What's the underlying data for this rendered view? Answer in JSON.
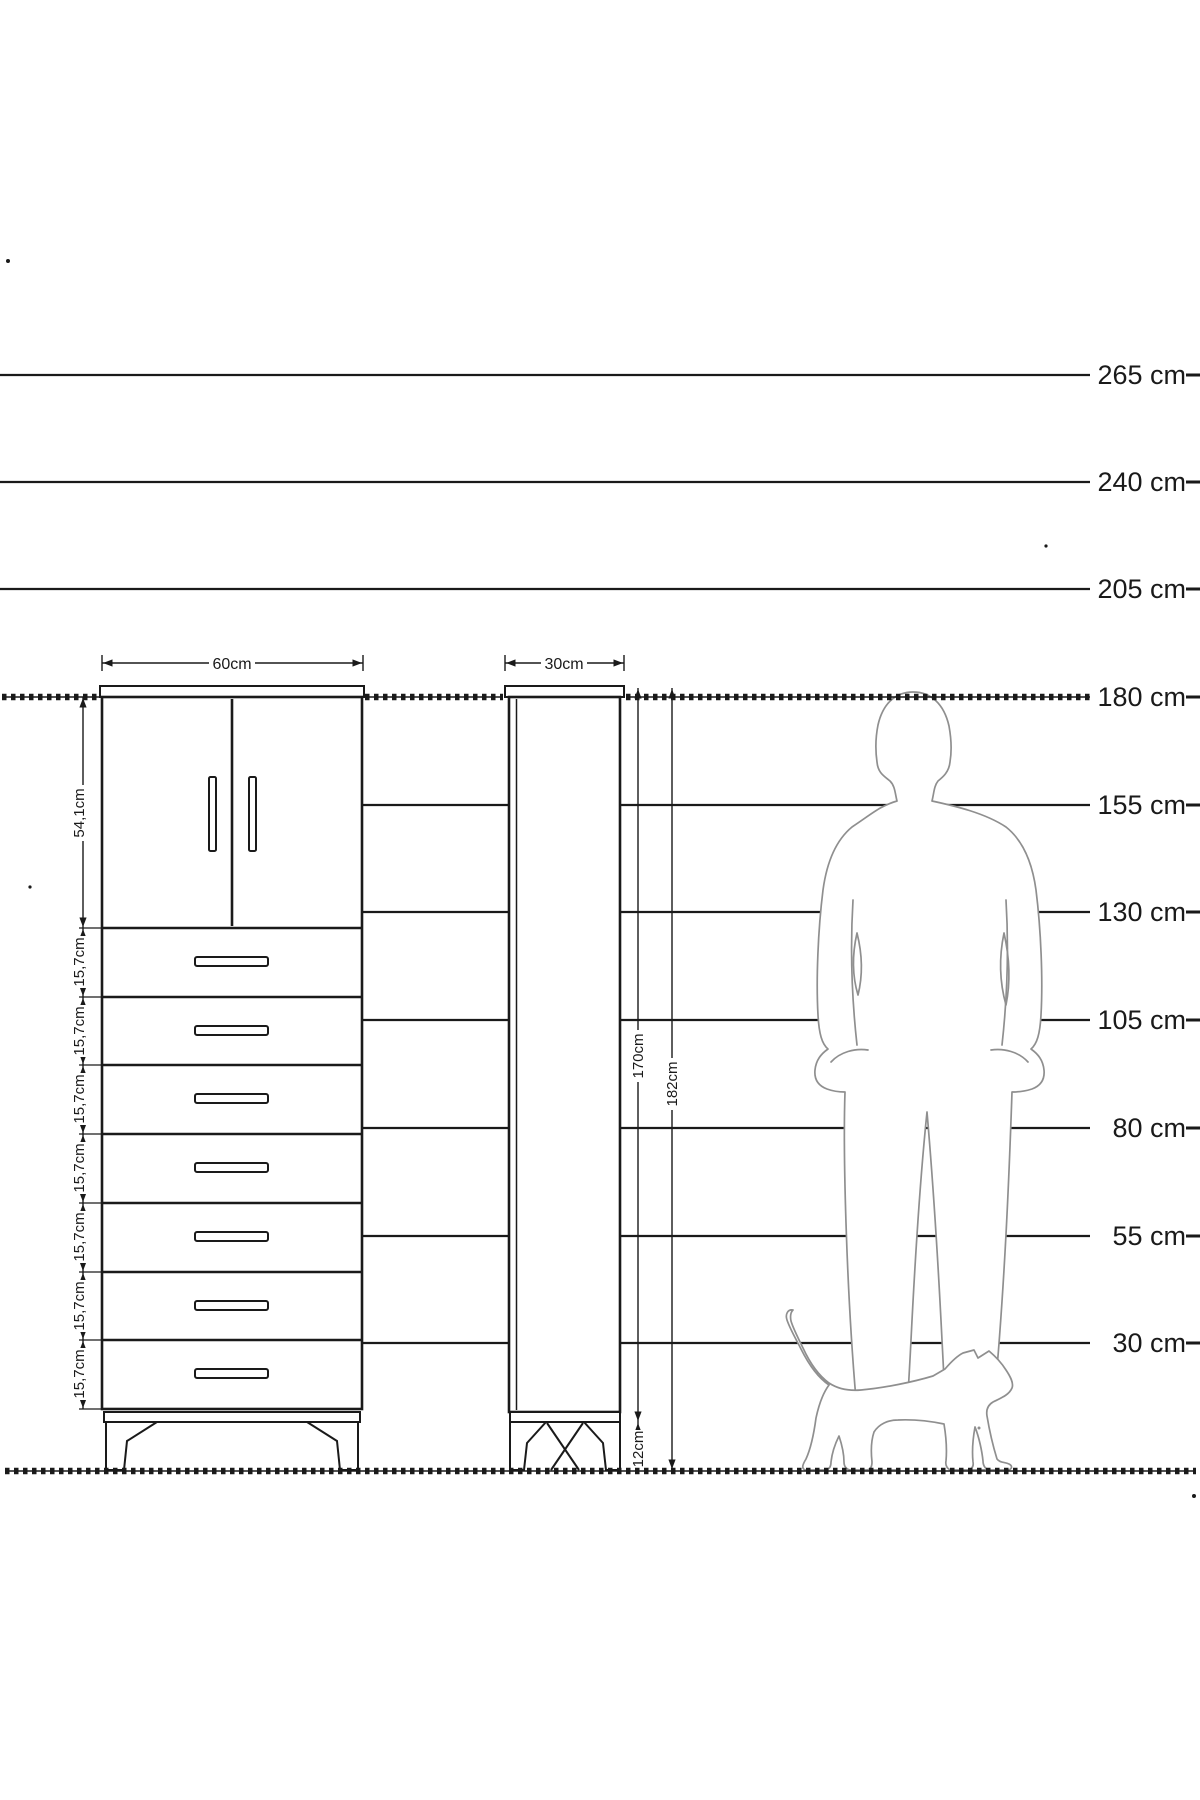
{
  "diagram": {
    "title": "Cabinet height comparison diagram",
    "unit": "cm",
    "height_scale": {
      "labels": [
        "265 cm",
        "240 cm",
        "205 cm",
        "180 cm",
        "155 cm",
        "130 cm",
        "105 cm",
        "80 cm",
        "55 cm",
        "30 cm"
      ],
      "values_cm": [
        265,
        240,
        205,
        180,
        155,
        130,
        105,
        80,
        55,
        30
      ]
    },
    "wide_cabinet": {
      "width_label": "60cm",
      "door_section_height_label": "54,1cm",
      "drawer_height_labels": [
        "15,7cm",
        "15,7cm",
        "15,7cm",
        "15,7cm",
        "15,7cm",
        "15,7cm",
        "15,7cm"
      ],
      "drawer_count": 7,
      "door_count": 2
    },
    "tall_cabinet": {
      "width_label": "30cm",
      "carcass_height_label": "170cm",
      "total_height_label": "182cm",
      "leg_height_label": "12cm"
    },
    "figures": {
      "man": "standing man silhouette",
      "cat": "walking cat silhouette"
    },
    "colors": {
      "line": "#1a1a1a",
      "silhouette_stroke": "#8f8f8f",
      "background": "#ffffff"
    }
  }
}
